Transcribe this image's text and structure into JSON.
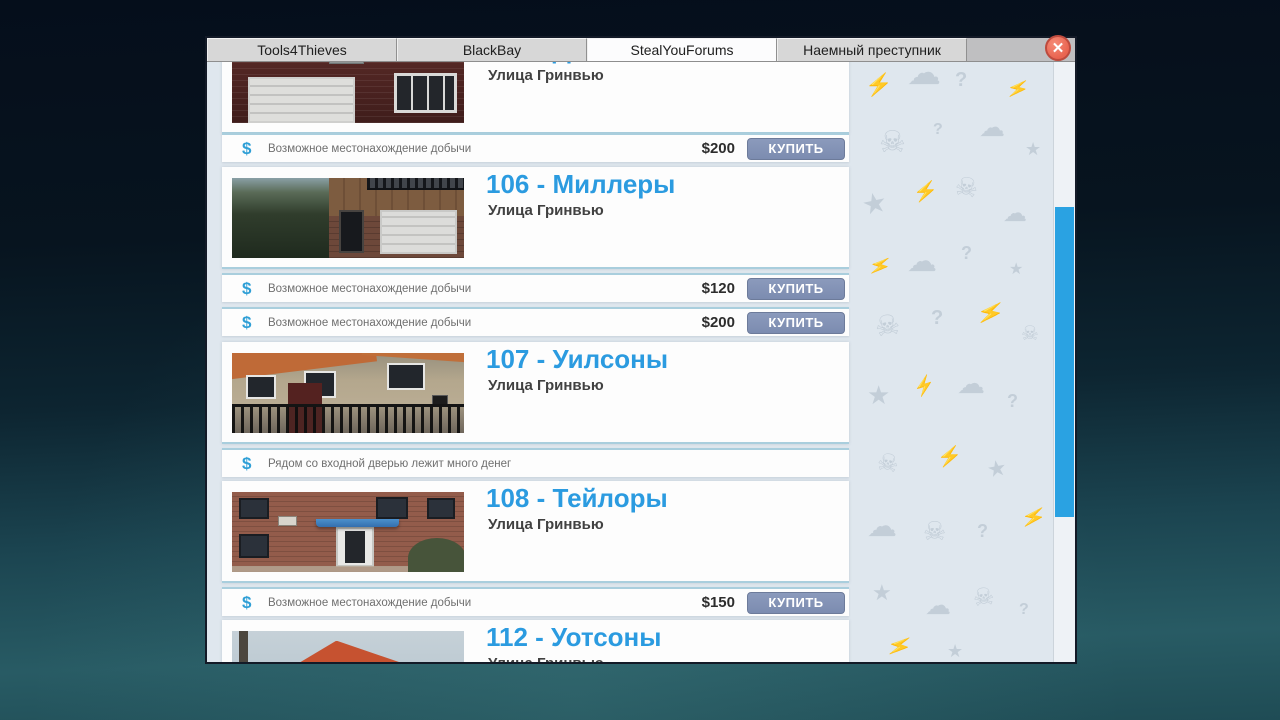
{
  "browser": {
    "tabs": [
      {
        "label": "Tools4Thieves",
        "active": false
      },
      {
        "label": "BlackBay",
        "active": false
      },
      {
        "label": "StealYouForums",
        "active": true
      },
      {
        "label": "Наемный преступник",
        "active": false
      }
    ],
    "close_glyph": "✕"
  },
  "listings": [
    {
      "title": "105 - Дэвисы",
      "address": "Улица Гринвью",
      "offers": [
        {
          "icon": "$",
          "text": "Возможное местонахождение добычи",
          "price": "$200",
          "button": "КУПИТЬ"
        }
      ]
    },
    {
      "title": "106 - Миллеры",
      "address": "Улица Гринвью",
      "offers": [
        {
          "icon": "$",
          "text": "Возможное местонахождение добычи",
          "price": "$120",
          "button": "КУПИТЬ"
        },
        {
          "icon": "$",
          "text": "Возможное местонахождение добычи",
          "price": "$200",
          "button": "КУПИТЬ"
        }
      ]
    },
    {
      "title": "107 - Уилсоны",
      "address": "Улица Гринвью",
      "offers": [
        {
          "icon": "$",
          "text": "Рядом со входной дверью лежит много денег"
        }
      ]
    },
    {
      "title": "108 - Тейлоры",
      "address": "Улица Гринвью",
      "offers": [
        {
          "icon": "$",
          "text": "Возможное местонахождение добычи",
          "price": "$150",
          "button": "КУПИТЬ"
        }
      ]
    },
    {
      "title": "112 - Уотсоны",
      "address": "Улица Гринвью",
      "offers": []
    }
  ],
  "colors": {
    "accent_blue": "#2b9be0",
    "buy_button": "#8292b6",
    "scrollbar_thumb": "#2aa2e2",
    "close_button": "#ee7261",
    "row_divider": "#a9cedd"
  },
  "pattern": {
    "glyphs": {
      "skull": "☠",
      "lightning": "⚡",
      "star": "★",
      "cloud": "☁",
      "question": "?"
    }
  }
}
